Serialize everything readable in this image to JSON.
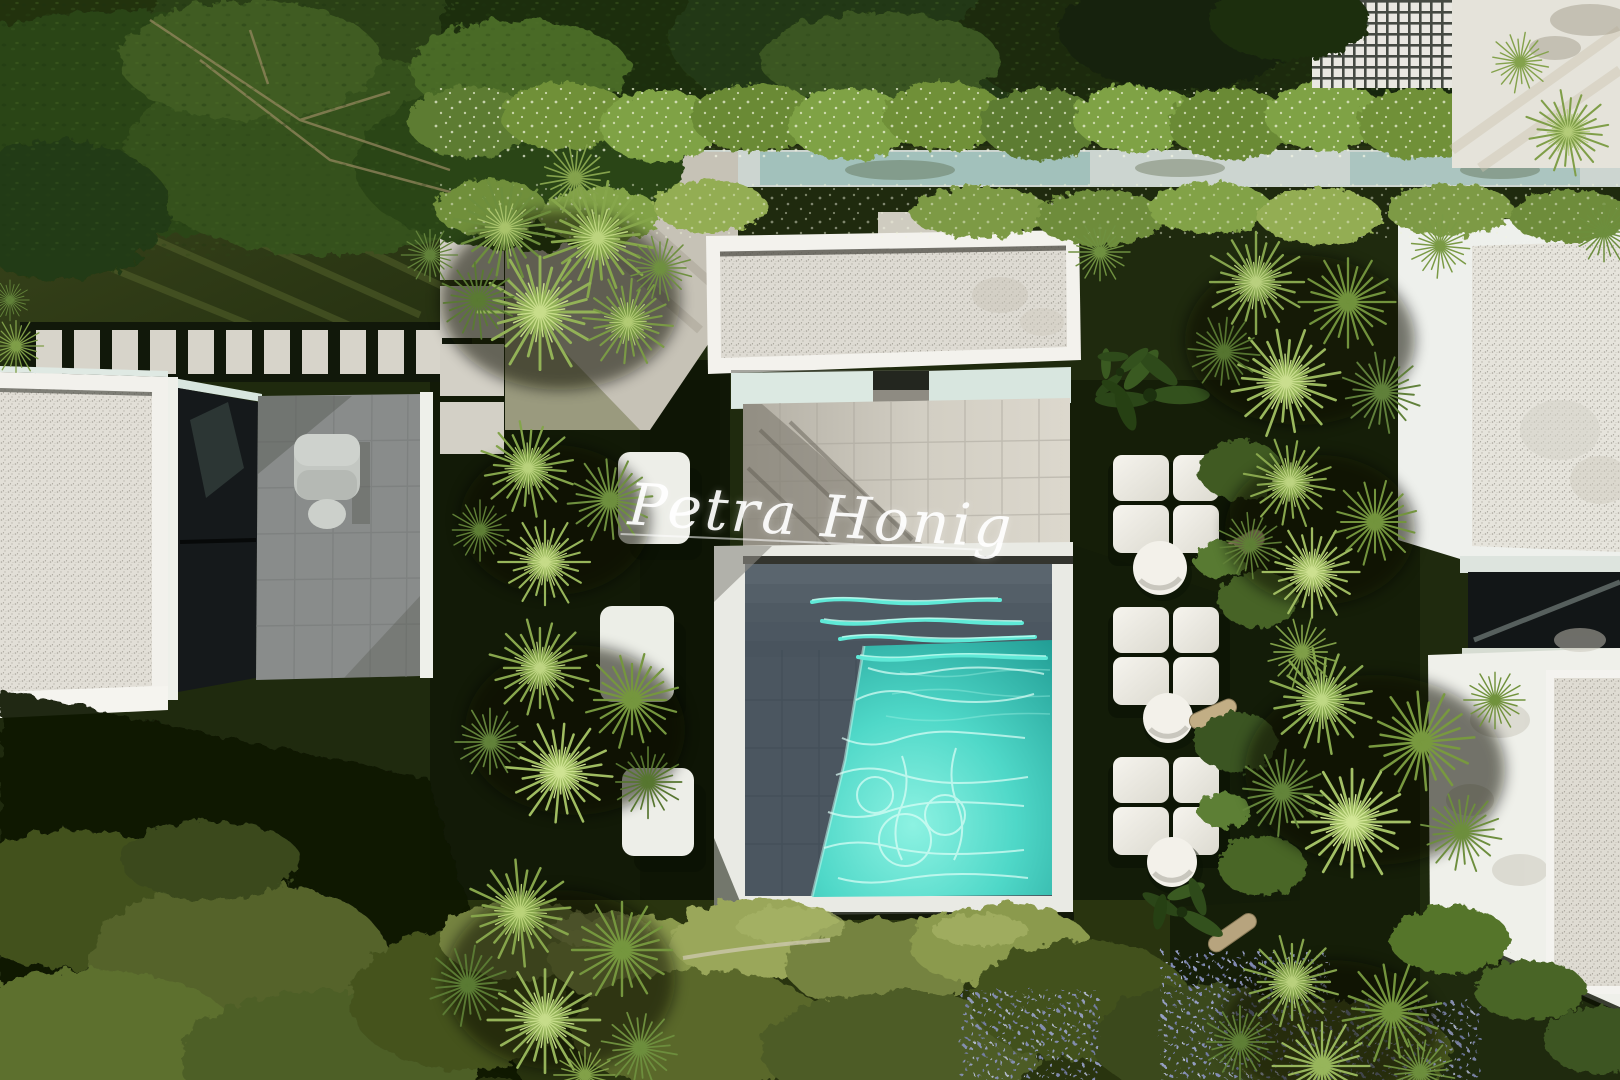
{
  "watermark": {
    "text": "Petra Honig"
  },
  "palette": {
    "pool_water_turquoise": "#4fd8c8",
    "pool_basin_slate": "#4b5660",
    "lawn_dark_green": "#1c2609",
    "roof_gravel_white": "#e0ddd4",
    "terrace_stone_gray": "#8b8e8d",
    "lounger_cushion_white": "#f2f0e9",
    "palm_foliage_green": "#7d9c4a",
    "flower_purple": "#9099cb",
    "facade_white": "#f2f1ec",
    "glass_dark": "#15191b"
  }
}
